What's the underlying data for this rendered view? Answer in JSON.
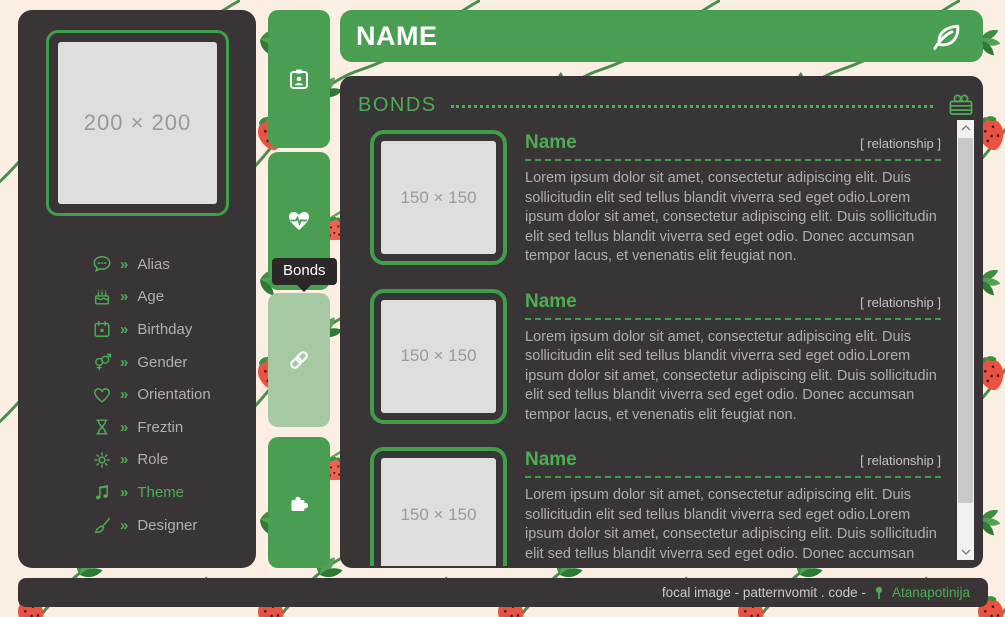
{
  "colors": {
    "accent_green": "#4a9e52",
    "accent_green_bright": "#4cae52",
    "active_tab_green": "#a6c9a4",
    "panel_dark": "#393537",
    "page_cream": "#fbeee3",
    "placeholder_gray": "#dedede"
  },
  "sidebar": {
    "image_placeholder": "200 × 200",
    "chevron": "»",
    "items": [
      {
        "icon": "comment-icon",
        "label": "Alias"
      },
      {
        "icon": "cake-icon",
        "label": "Age"
      },
      {
        "icon": "calendar-icon",
        "label": "Birthday"
      },
      {
        "icon": "venus-mars-icon",
        "label": "Gender"
      },
      {
        "icon": "heart-icon",
        "label": "Orientation"
      },
      {
        "icon": "hourglass-icon",
        "label": "Freztin"
      },
      {
        "icon": "gear-icon",
        "label": "Role"
      },
      {
        "icon": "music-icon",
        "label": "Theme"
      },
      {
        "icon": "paintbrush-icon",
        "label": "Designer"
      }
    ]
  },
  "tabs": {
    "tooltip": "Bonds",
    "items": [
      {
        "name": "profile",
        "icon": "id-badge-icon",
        "active": false
      },
      {
        "name": "health",
        "icon": "heart-pulse-icon",
        "active": false
      },
      {
        "name": "bonds",
        "icon": "link-icon",
        "active": true
      },
      {
        "name": "extras",
        "icon": "puzzle-icon",
        "active": false
      }
    ]
  },
  "header": {
    "title": "NAME",
    "icon": "leaf-icon"
  },
  "bonds": {
    "section_title": "BONDS",
    "section_icon": "crate-icon",
    "entries": [
      {
        "name": "Name",
        "relationship": "[ relationship ]",
        "image_placeholder": "150 × 150",
        "description": "Lorem ipsum dolor sit amet, consectetur adipiscing elit. Duis sollicitudin elit sed tellus blandit viverra sed eget odio.Lorem ipsum dolor sit amet, consectetur adipiscing elit. Duis sollicitudin elit sed tellus blandit viverra sed eget odio. Donec accumsan tempor lacus, et venenatis elit feugiat non."
      },
      {
        "name": "Name",
        "relationship": "[ relationship ]",
        "image_placeholder": "150 × 150",
        "description": "Lorem ipsum dolor sit amet, consectetur adipiscing elit. Duis sollicitudin elit sed tellus blandit viverra sed eget odio.Lorem ipsum dolor sit amet, consectetur adipiscing elit. Duis sollicitudin elit sed tellus blandit viverra sed eget odio. Donec accumsan tempor lacus, et venenatis elit feugiat non."
      },
      {
        "name": "Name",
        "relationship": "[ relationship ]",
        "image_placeholder": "150 × 150",
        "description": "Lorem ipsum dolor sit amet, consectetur adipiscing elit. Duis sollicitudin elit sed tellus blandit viverra sed eget odio.Lorem ipsum dolor sit amet, consectetur adipiscing elit. Duis sollicitudin elit sed tellus blandit viverra sed eget odio. Donec accumsan tempor lacus, et venenatis elit feugiat non."
      }
    ]
  },
  "footer": {
    "credit": "focal image - patternvomit . code -",
    "link_icon": "map-pin-icon",
    "link": "Atanapotinija"
  }
}
